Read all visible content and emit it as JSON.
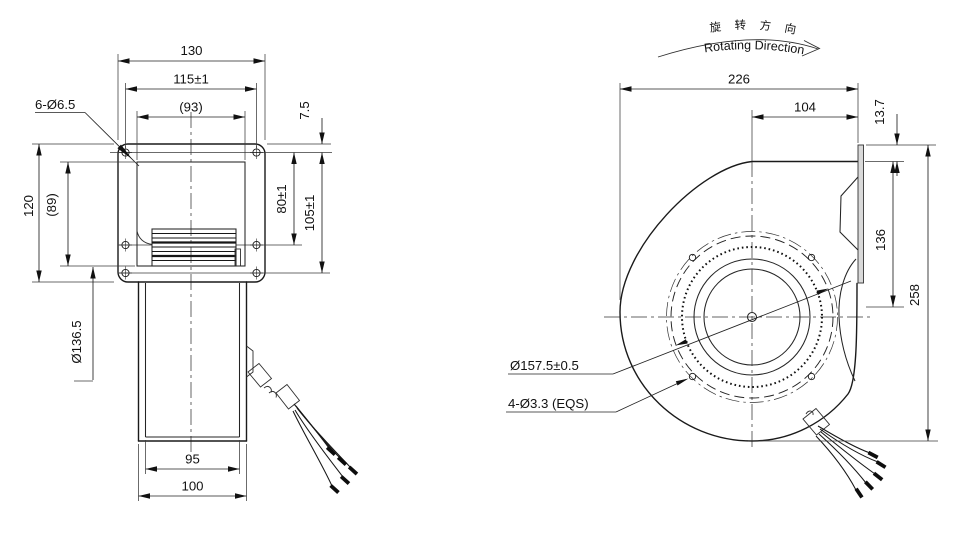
{
  "left_view": {
    "dim_width_overall": "130",
    "dim_hole_pitch_h": "115±1",
    "dim_inner_width": "(93)",
    "label_mount_holes": "6-Ø6.5",
    "dim_flange_to_hole": "7.5",
    "dim_height_overall": "120",
    "dim_inner_height": "(89)",
    "dim_hole_pitch_v_upper": "80±1",
    "dim_hole_pitch_v_lower": "105±1",
    "dim_body_diameter": "Ø136.5",
    "dim_outlet_inner_width": "95",
    "dim_outlet_outer_width": "100"
  },
  "right_view": {
    "rotating_direction_cn": "旋 转 方 向",
    "rotating_direction_en": "Rotating Direction",
    "dim_depth_overall": "226",
    "dim_center_to_outlet": "104",
    "dim_outlet_lip": "13.7",
    "dim_outlet_height": "136",
    "dim_height_overall": "258",
    "label_impeller_diameter": "Ø157.5±0.5",
    "label_impeller_holes": "4-Ø3.3 (EQS)"
  }
}
